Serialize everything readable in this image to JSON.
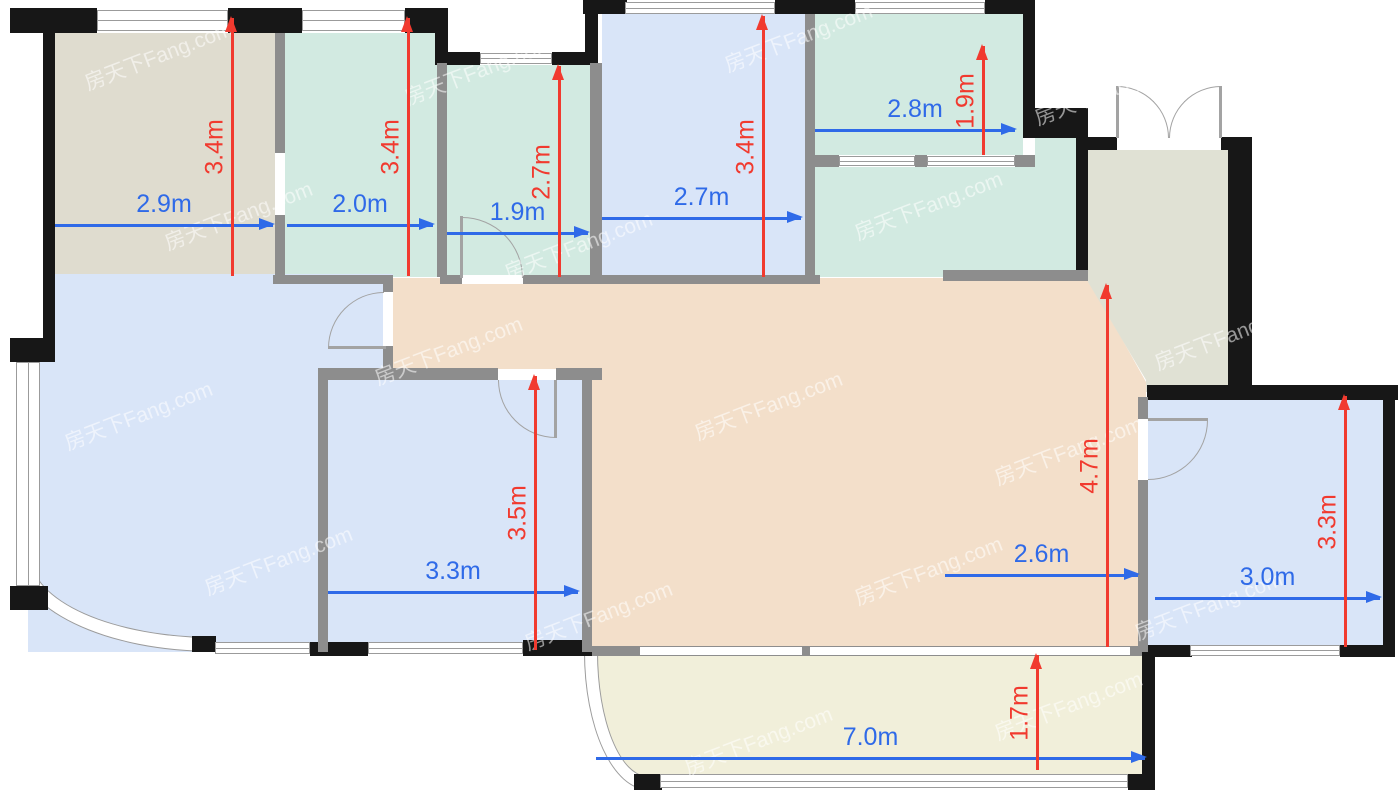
{
  "app": {
    "type": "floor-plan-viewer",
    "title": "apartment floor plan with dimensions"
  },
  "watermark": {
    "text": "房天下Fang.com"
  },
  "colors": {
    "wall": "#171717",
    "iwall": "#8d8d8d",
    "winline": "#9b9b9b",
    "door": "#a3a3a3",
    "beige": "#dfdccf",
    "teal": "#d2eae1",
    "blue": "#d9e5f8",
    "peach": "#f3dfca",
    "balcony": "#f1efda",
    "entry": "#e0e1d4",
    "dimblue": "#2f6ae8",
    "dimred": "#f13a2f"
  },
  "dims": {
    "h0": {
      "label": "2.9m",
      "orientation": "horizontal",
      "room": "top-left-room"
    },
    "h1": {
      "label": "2.0m",
      "orientation": "horizontal",
      "room": "top-room-2"
    },
    "h2": {
      "label": "1.9m",
      "orientation": "horizontal",
      "room": "top-small-room"
    },
    "h3": {
      "label": "2.7m",
      "orientation": "horizontal",
      "room": "top-room-4"
    },
    "h4": {
      "label": "2.8m",
      "orientation": "horizontal",
      "room": "top-right-room"
    },
    "h5": {
      "label": "3.3m",
      "orientation": "horizontal",
      "room": "center-small-room"
    },
    "h6": {
      "label": "2.6m",
      "orientation": "horizontal",
      "room": "living-dining"
    },
    "h7": {
      "label": "3.0m",
      "orientation": "horizontal",
      "room": "right-room"
    },
    "h8": {
      "label": "7.0m",
      "orientation": "horizontal",
      "room": "balcony"
    },
    "v0": {
      "label": "3.4m",
      "orientation": "vertical",
      "room": "top-left-room"
    },
    "v1": {
      "label": "3.4m",
      "orientation": "vertical",
      "room": "top-room-2"
    },
    "v2": {
      "label": "2.7m",
      "orientation": "vertical",
      "room": "top-small-room"
    },
    "v3": {
      "label": "3.4m",
      "orientation": "vertical",
      "room": "top-room-4"
    },
    "v4": {
      "label": "1.9m",
      "orientation": "vertical",
      "room": "top-right-room"
    },
    "v5": {
      "label": "4.7m",
      "orientation": "vertical",
      "room": "living-dining"
    },
    "v6": {
      "label": "3.5m",
      "orientation": "vertical",
      "room": "center-small-room"
    },
    "v7": {
      "label": "3.3m",
      "orientation": "vertical",
      "room": "right-room"
    },
    "v8": {
      "label": "1.7m",
      "orientation": "vertical",
      "room": "balcony"
    }
  }
}
